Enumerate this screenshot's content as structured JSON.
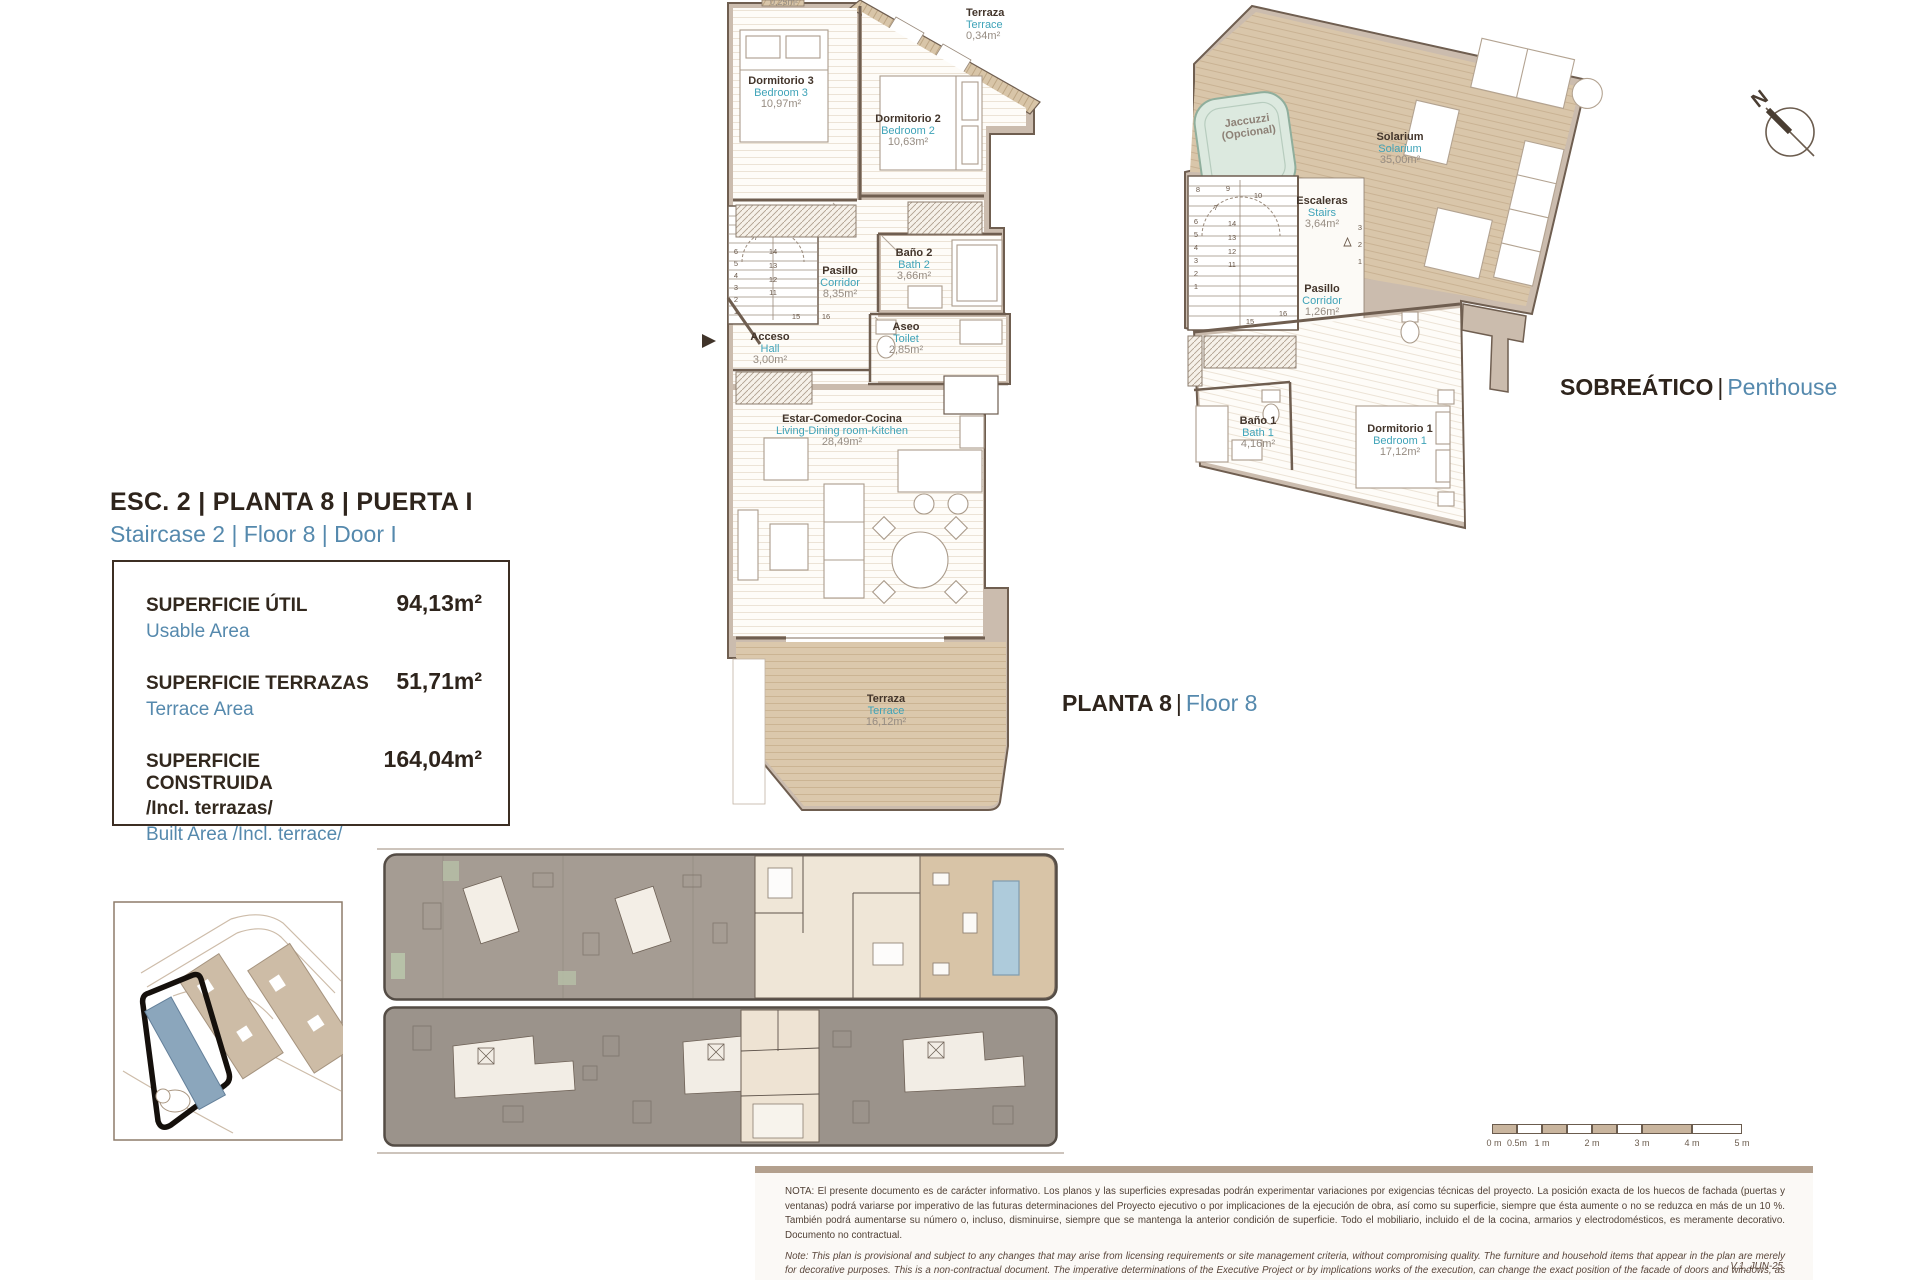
{
  "header": {
    "title_es": "ESC. 2 | PLANTA 8 | PUERTA I",
    "title_en": "Staircase 2 | Floor 8 | Door I"
  },
  "labels": {
    "floor_tag": {
      "es": "PLANTA 8",
      "sep": "|",
      "en": "Floor 8"
    },
    "penthouse_tag": {
      "es": "SOBREÁTICO",
      "sep": "|",
      "en": "Penthouse"
    },
    "north": "N"
  },
  "summary": {
    "rows": [
      {
        "label_es": "SUPERFICIE ÚTIL",
        "label_en": "Usable Area",
        "value": "94,13m²"
      },
      {
        "label_es": "SUPERFICIE TERRAZAS",
        "label_en": "Terrace Area",
        "value": "51,71m²"
      },
      {
        "label_es": "SUPERFICIE CONSTRUIDA",
        "label_es2": "/Incl. terrazas/",
        "label_en": "Built Area /Incl. terrace/",
        "value": "164,04m²"
      }
    ]
  },
  "rooms": {
    "apartment": {
      "terraza_tiny_area": "0,25m²",
      "terraza_top": {
        "es": "Terraza",
        "en": "Terrace",
        "area": "0,34m²"
      },
      "dorm3": {
        "es": "Dormitorio 3",
        "en": "Bedroom 3",
        "area": "10,97m²"
      },
      "dorm2": {
        "es": "Dormitorio 2",
        "en": "Bedroom 2",
        "area": "10,63m²"
      },
      "bano2": {
        "es": "Baño 2",
        "en": "Bath 2",
        "area": "3,66m²"
      },
      "pasillo": {
        "es": "Pasillo",
        "en": "Corridor",
        "area": "8,35m²"
      },
      "aseo": {
        "es": "Aseo",
        "en": "Toilet",
        "area": "2,85m²"
      },
      "acceso": {
        "es": "Acceso",
        "en": "Hall",
        "area": "3,00m²"
      },
      "living": {
        "es": "Estar-Comedor-Cocina",
        "en": "Living-Dining room-Kitchen",
        "area": "28,49m²"
      },
      "terraza": {
        "es": "Terraza",
        "en": "Terrace",
        "area": "16,12m²"
      }
    },
    "penthouse": {
      "jacuzzi": {
        "line1": "Jaccuzzi",
        "line2": "(Opcional)"
      },
      "solarium": {
        "es": "Solarium",
        "en": "Solarium",
        "area": "35,00m²"
      },
      "escaleras": {
        "es": "Escaleras",
        "en": "Stairs",
        "area": "3,64m²"
      },
      "pasillo": {
        "es": "Pasillo",
        "en": "Corridor",
        "area": "1,26m²"
      },
      "bano1": {
        "es": "Baño 1",
        "en": "Bath 1",
        "area": "4,16m²"
      },
      "dorm1": {
        "es": "Dormitorio 1",
        "en": "Bedroom 1",
        "area": "17,12m²"
      }
    }
  },
  "stairs": {
    "apartment": {
      "top": [
        "8",
        "9",
        "10"
      ],
      "mid7": "7",
      "left": [
        "6",
        "5",
        "4",
        "3",
        "2",
        "1"
      ],
      "mid": [
        "14",
        "13",
        "12",
        "11"
      ],
      "bottom": [
        "15",
        "16"
      ]
    },
    "penthouse": {
      "top": [
        "8",
        "9",
        "10"
      ],
      "mid7": "7",
      "left": [
        "6",
        "5",
        "4",
        "3",
        "2",
        "1"
      ],
      "mid": [
        "14",
        "13",
        "12",
        "11"
      ],
      "bottom": [
        "15",
        "16"
      ],
      "right": [
        "3",
        "2",
        "1"
      ]
    }
  },
  "scalebar": {
    "labels": [
      "0 m",
      "0.5m",
      "1 m",
      "2 m",
      "3 m",
      "4 m",
      "5 m"
    ]
  },
  "note": {
    "es": "NOTA:  El presente documento es de carácter informativo. Los planos y las superficies expresadas podrán experimentar variaciones por exigencias técnicas del proyecto. La posición exacta de los huecos de fachada (puertas y ventanas) podrá variarse por imperativo de las futuras determinaciones del Proyecto ejecutivo o por implicaciones de la ejecución de obra, así como su superficie, siempre que ésta aumente o no se reduzca en más de un 10 %. También podrá aumentarse su número o, incluso, disminuirse, siempre que se mantenga la anterior condición de superficie. Todo el mobiliario, incluido el de la cocina, armarios y electrodomésticos, es meramente decorativo. Documento no contractual.",
    "en": "Note: This plan is provisional and subject to any changes that may arise from licensing requirements or site management criteria, without compromising quality. The furniture and household items that appear in the plan are merely for decorative purposes. This is a non-contractual document. The imperative determinations of the Executive Project or by implications works of the execution, can change the exact position of the facade of doors and windows, as well the surface area may also be increased or even decrease not more than a 10%.",
    "version": "V.1_JUN-25"
  }
}
